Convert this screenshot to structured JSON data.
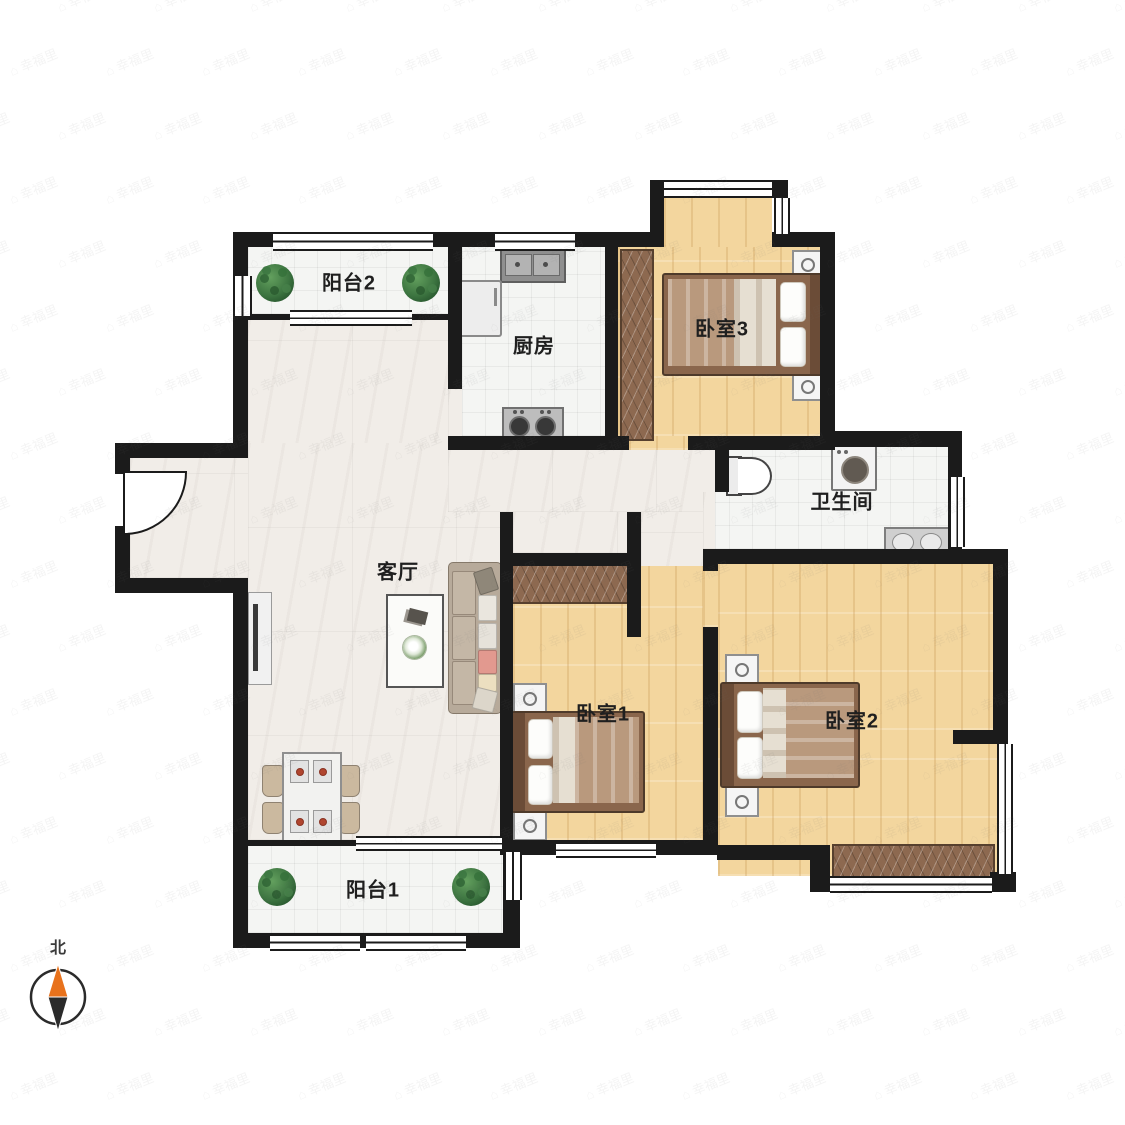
{
  "page": {
    "background": "#ffffff"
  },
  "rooms": [
    {
      "id": "balcony-2",
      "label": "阳台2"
    },
    {
      "id": "kitchen",
      "label": "厨房"
    },
    {
      "id": "bedroom-3",
      "label": "卧室3"
    },
    {
      "id": "bathroom",
      "label": "卫生间"
    },
    {
      "id": "living-room",
      "label": "客厅"
    },
    {
      "id": "bedroom-1",
      "label": "卧室1"
    },
    {
      "id": "bedroom-2",
      "label": "卧室2"
    },
    {
      "id": "balcony-1",
      "label": "阳台1"
    }
  ],
  "compass": {
    "label": "北",
    "north_color": "#e8721c",
    "south_color": "#2b2b2b"
  },
  "watermark": {
    "icon": "house-logo-icon",
    "glyph": "⌂",
    "text": "幸福里"
  },
  "colors": {
    "wall": "#1b1b1b",
    "wood_floor": "#f3d69e",
    "marble_floor": "#f1ede8",
    "tile_floor": "#f4f5f3",
    "wardrobe": "#8d6950",
    "bed_blanket": "#b9997d",
    "sofa": "#b7aa9a",
    "plant": "#3c7440"
  }
}
